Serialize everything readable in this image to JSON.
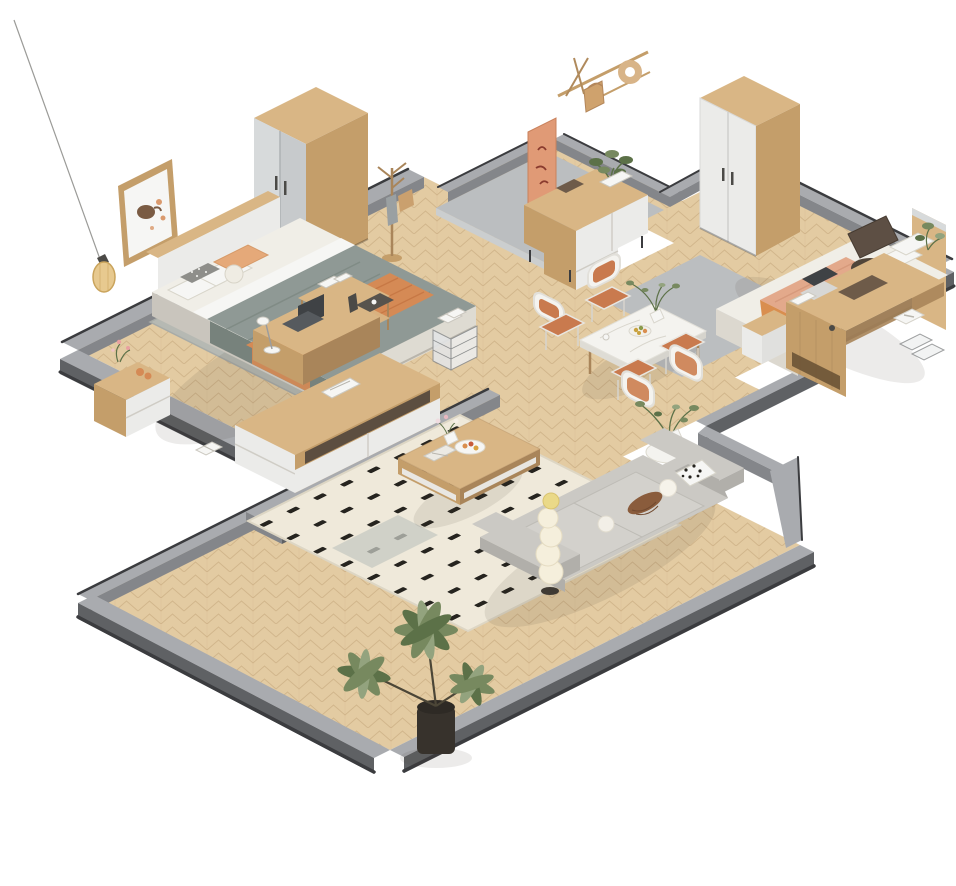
{
  "meta": {
    "title": "3D isometric cutaway render of a furnished apartment",
    "view": "axonometric bird's-eye cutaway, low gray walls, white background",
    "background": "#ffffff"
  },
  "palette": {
    "background": "#ffffff",
    "wood": "#e3cba2",
    "parquetLine": "#bb9c6f",
    "concrete": "#bbbec0",
    "concreteLight": "#cbcecf",
    "wallTop": "#a9abaf",
    "wallDark": "#84868a",
    "wallDarker": "#5f6164",
    "wallBase": "#3b3c3f",
    "furnWood": "#d9b685",
    "furnWoodSide": "#c49e6a",
    "furnWoodDark": "#a9855a",
    "white": "#f6f6f4",
    "panel": "#ebebe9",
    "grayDoor": "#c7cacc",
    "grayDoorLight": "#d7dadb",
    "sheet": "#f0eee7",
    "duvet": "#8f9995",
    "duvetShade": "#77827c",
    "throwOrange": "#d58a55",
    "pillowOrange": "#e5a979",
    "rugGray": "#b6b9b3",
    "rugCream": "#efe9da",
    "rugDash": "#26241f",
    "marble": "#f4f3ef",
    "chairCushion": "#c97a4e",
    "leaf": "#77895f",
    "leafDark": "#5c7148",
    "leafLight": "#93a37e",
    "pot": "#37322c",
    "amber": "#e7c98f",
    "dark": "#4b4a47",
    "laptop": "#3f4245",
    "fabric": "#cbc9c4",
    "fabricShade": "#b1afaa",
    "blanketPeach": "#e3a98b",
    "blanketOrange": "#d98e4f",
    "chairBrown": "#5d4f44"
  },
  "scene": {
    "rooms": [
      {
        "id": "master-bedroom",
        "label": "Master bedroom",
        "floor": "herringbone parquet",
        "position": "top-left"
      },
      {
        "id": "entry-hall",
        "label": "Entry hall",
        "floor": "concrete",
        "position": "top-center"
      },
      {
        "id": "second-bedroom",
        "label": "Second bedroom",
        "floor": "herringbone parquet",
        "position": "top-right"
      },
      {
        "id": "dining-area",
        "label": "Dining area",
        "floor": "parquet with concrete patch",
        "position": "center"
      },
      {
        "id": "living-room",
        "label": "Living room",
        "floor": "herringbone parquet",
        "position": "bottom"
      }
    ],
    "objects": [
      {
        "id": "double-bed",
        "room": "master-bedroom",
        "label": "Double bed with white headboard, sage duvet and orange throw"
      },
      {
        "id": "art-frame",
        "room": "master-bedroom",
        "label": "Framed teapot artwork above headboard"
      },
      {
        "id": "pendant-lamp",
        "room": "master-bedroom",
        "label": "Amber glass pendant lamp on long cord"
      },
      {
        "id": "nightstand-left",
        "room": "master-bedroom",
        "label": "Two-drawer nightstand with flowers and fruit"
      },
      {
        "id": "nightstand-right",
        "room": "master-bedroom",
        "label": "Nightstand with plant and clock"
      },
      {
        "id": "sliding-wardrobe",
        "room": "master-bedroom",
        "label": "Oak wardrobe with gray sliding doors"
      },
      {
        "id": "coat-rack",
        "room": "master-bedroom",
        "label": "Wooden coat stand with bag"
      },
      {
        "id": "bedroom-rug",
        "room": "master-bedroom",
        "label": "Gray area rug under bed"
      },
      {
        "id": "work-desk",
        "room": "master-bedroom",
        "label": "Desk with laptop, lamp, bottle, tray and wire basket"
      },
      {
        "id": "book-shelf",
        "room": "master-bedroom",
        "label": "Open shelf with books at bed foot"
      },
      {
        "id": "tv-console",
        "room": "master-bedroom",
        "label": "Low TV console with white drawers and magazine"
      },
      {
        "id": "floor-book",
        "room": "master-bedroom",
        "label": "Open book on floor"
      },
      {
        "id": "entry-sideboard",
        "room": "entry-hall",
        "label": "Sideboard with white doors, bonsai plant and box"
      },
      {
        "id": "leaning-poster",
        "room": "entry-hall",
        "label": "Salmon calligraphy poster"
      },
      {
        "id": "wall-hooks",
        "room": "entry-hall",
        "label": "Wall rack with round hat, hanging bag and sticks"
      },
      {
        "id": "two-door-wardrobe",
        "room": "second-bedroom",
        "label": "White two-door wardrobe with oak frame"
      },
      {
        "id": "single-bed",
        "room": "second-bedroom",
        "label": "Bed with peach blanket, pillows and greenery"
      },
      {
        "id": "headboard-panel",
        "room": "second-bedroom",
        "label": "Tall wood headboard panel"
      },
      {
        "id": "bedside-drawer",
        "room": "second-bedroom",
        "label": "Small white drawer unit at bed foot"
      },
      {
        "id": "office-desk",
        "room": "second-bedroom",
        "label": "Large oak desk with laptop, blotter, tissue box and organizers"
      },
      {
        "id": "office-chair",
        "room": "second-bedroom",
        "label": "Dark brown office chair"
      },
      {
        "id": "dining-table",
        "room": "dining-area",
        "label": "White marble dining table with fruit bowl and branch vase"
      },
      {
        "id": "dining-chairs",
        "room": "dining-area",
        "label": "Four white chairs with orange cushions"
      },
      {
        "id": "round-side-table",
        "room": "dining-area",
        "label": "Round white pedestal table with leafy vase"
      },
      {
        "id": "living-rug",
        "room": "living-room",
        "label": "Cream rug with black dash pattern"
      },
      {
        "id": "coffee-table",
        "room": "living-room",
        "label": "Oak coffee table with tray, fruit, flowers and book"
      },
      {
        "id": "gray-sofa",
        "room": "living-room",
        "label": "Gray three-seat sofa with dalmatian, pom and corduroy pillows"
      },
      {
        "id": "bubble-floor-lamp",
        "room": "living-room",
        "label": "Stacked bubble floor lamp"
      },
      {
        "id": "large-potted-plant",
        "room": "living-room",
        "label": "Large potted palm plant in dark pot"
      }
    ]
  }
}
